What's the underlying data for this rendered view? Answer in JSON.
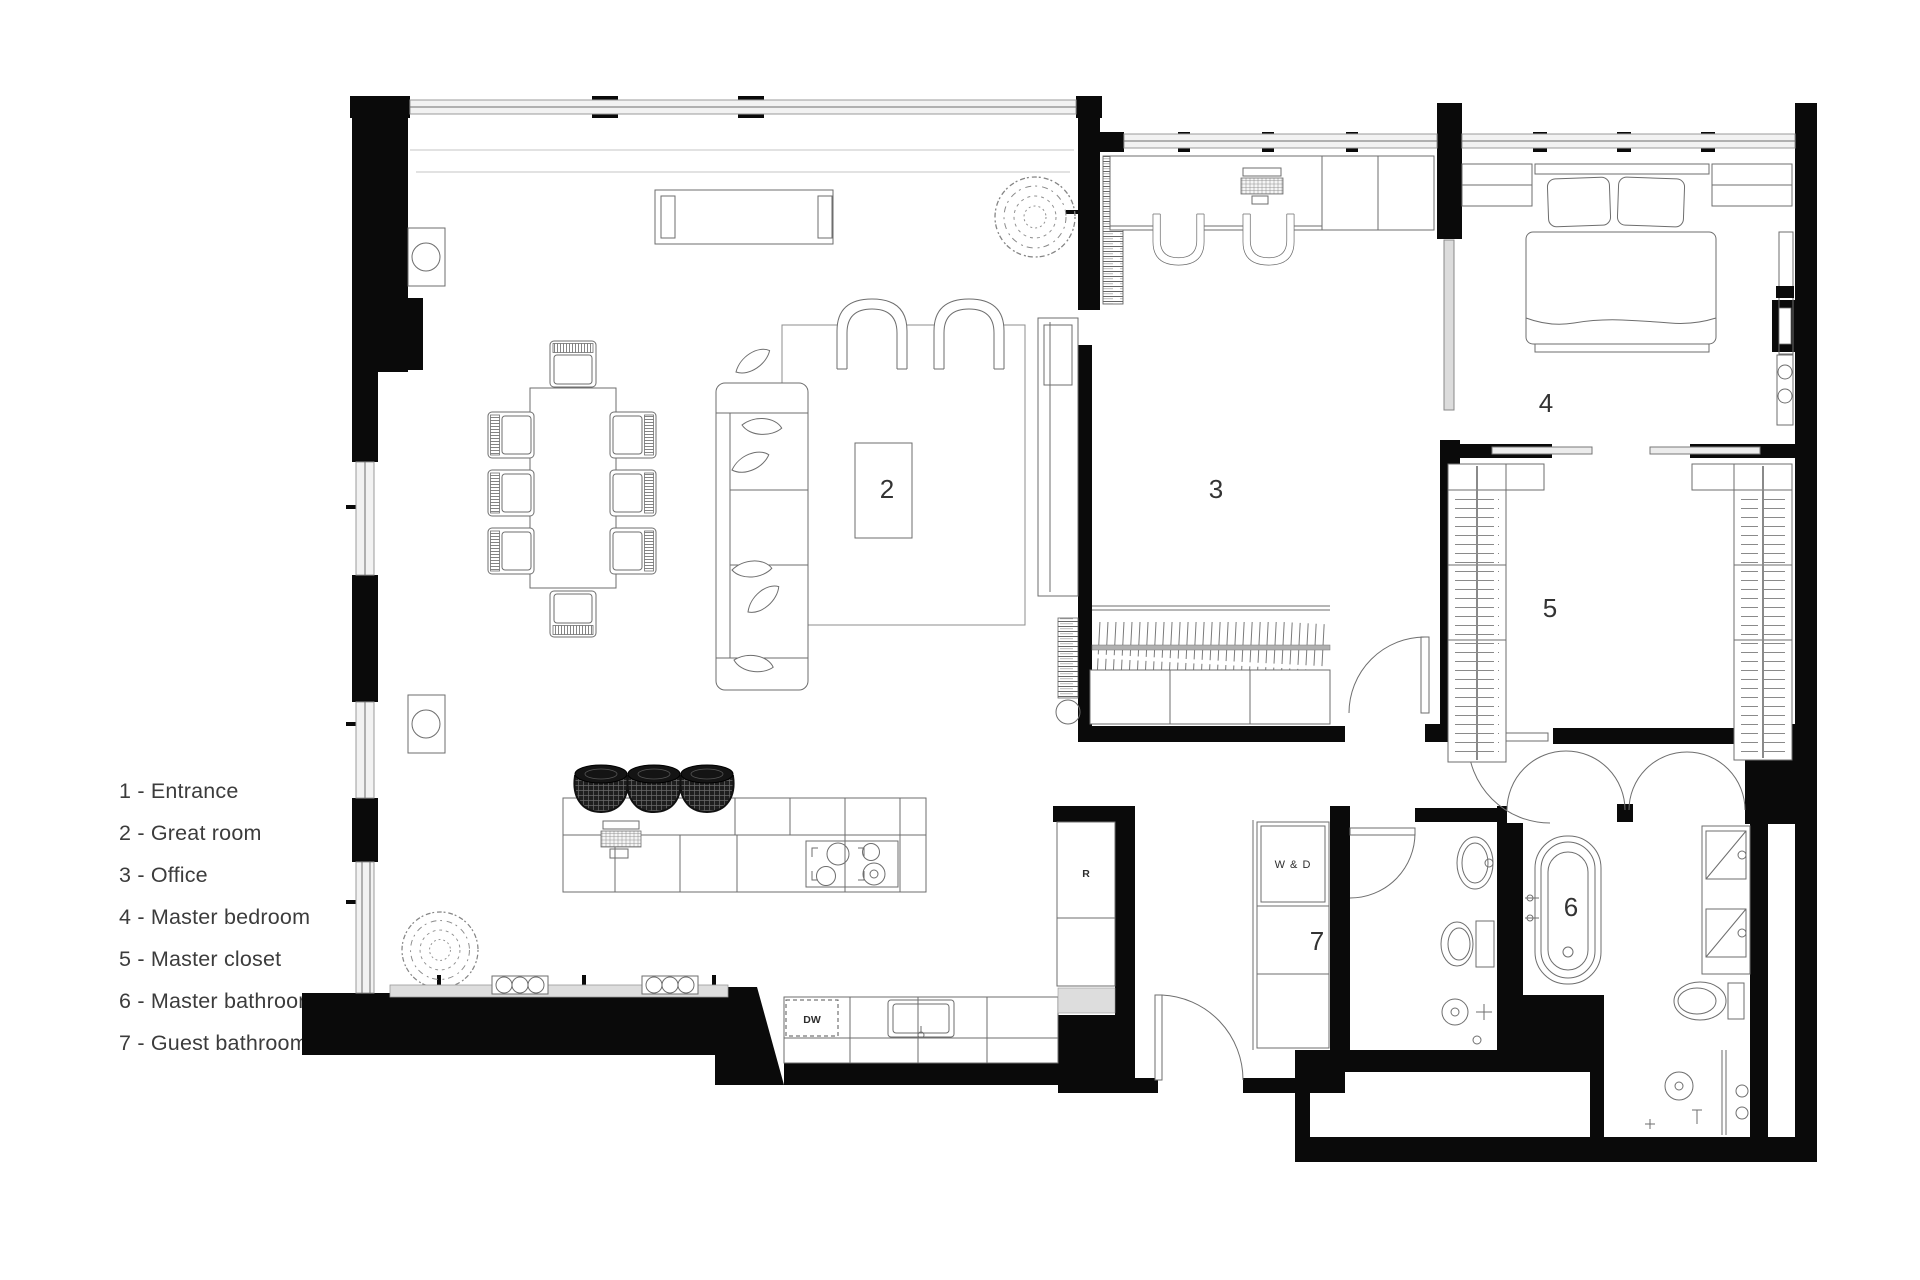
{
  "legend": {
    "items": [
      "1 - Entrance",
      "2 - Great room",
      "3 - Office",
      "4 - Master bedroom",
      "5 - Master closet",
      "6 - Master bathroom",
      "7 - Guest bathroom"
    ]
  },
  "rooms": {
    "great_room": "2",
    "office": "3",
    "master_bedroom": "4",
    "master_closet": "5",
    "master_bathroom": "6",
    "guest_bathroom": "7"
  },
  "appliances": {
    "washer_dryer": "W & D",
    "refrigerator": "R",
    "dishwasher": "DW"
  },
  "colors": {
    "wall": "#0a0a0a",
    "line": "#6e6e6e",
    "window_fill": "#f2f2f2",
    "background": "#ffffff"
  }
}
